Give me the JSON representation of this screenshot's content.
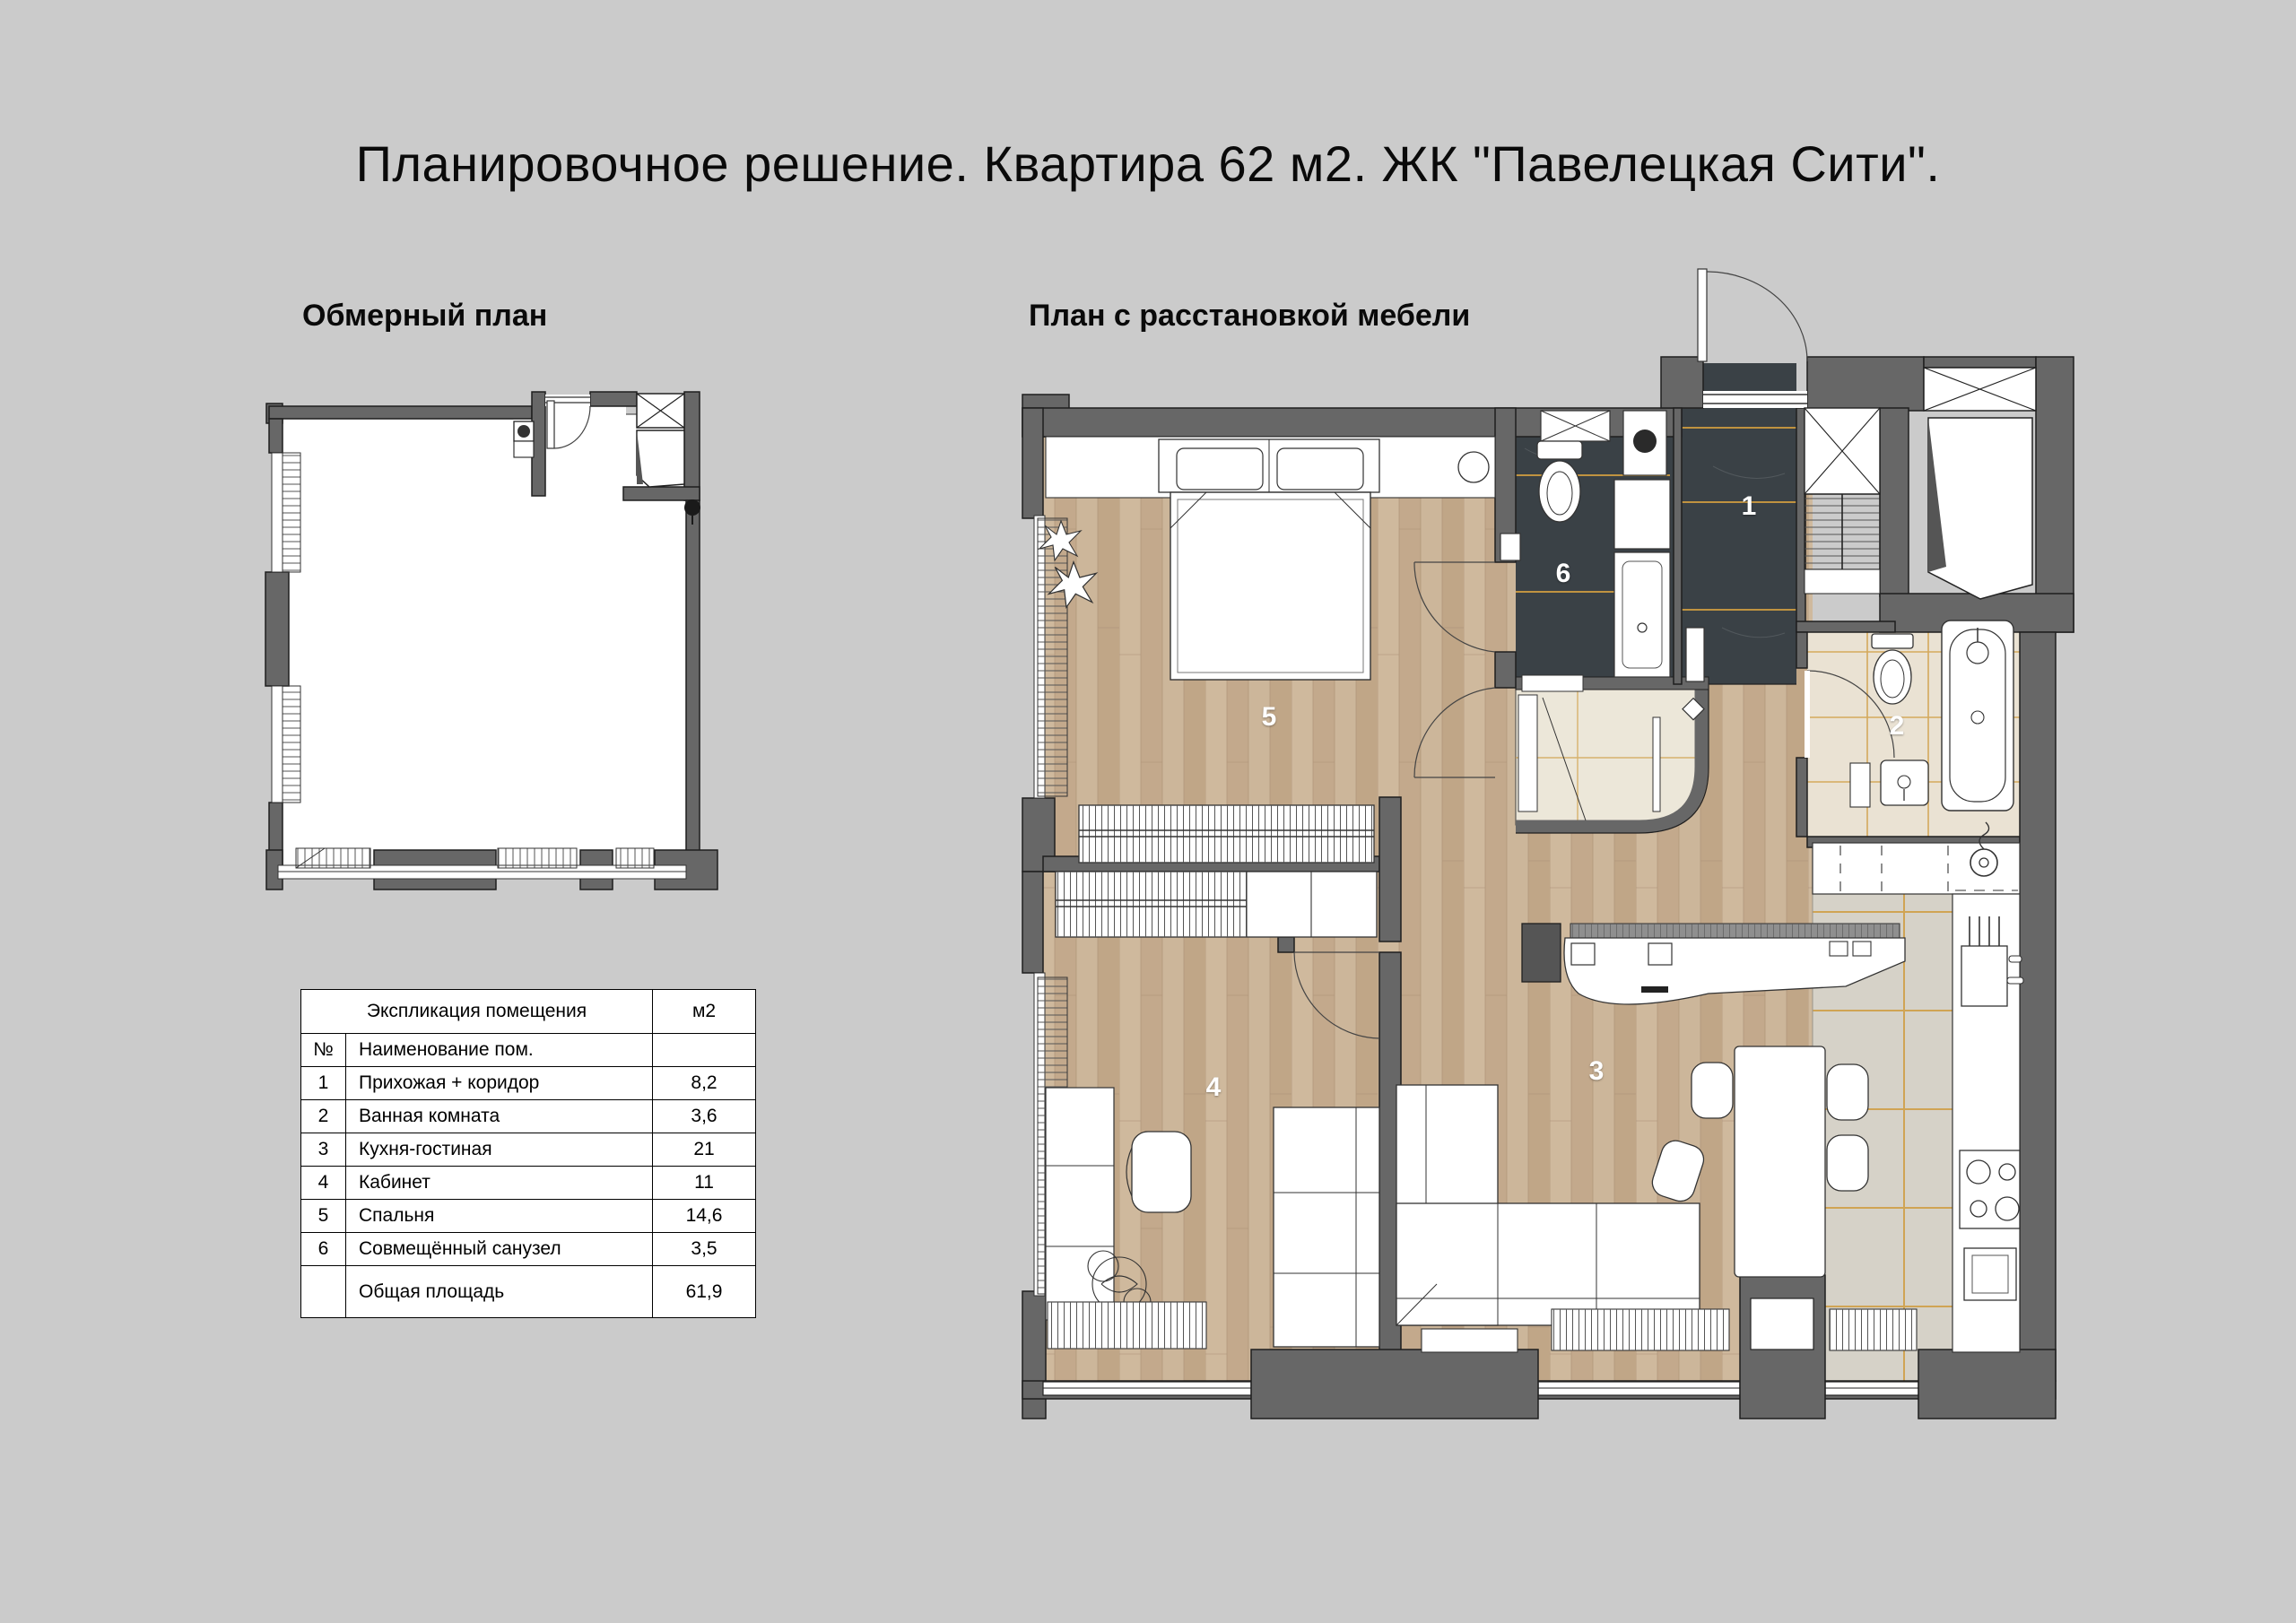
{
  "title": "Планировочное решение. Квартира 62 м2. ЖК \"Павелецкая Сити\".",
  "sections": {
    "left": "Обмерный план",
    "right": "План с расстановкой мебели"
  },
  "rooms": [
    {
      "label": "1"
    },
    {
      "label": "2"
    },
    {
      "label": "3"
    },
    {
      "label": "4"
    },
    {
      "label": "5"
    },
    {
      "label": "6"
    }
  ],
  "table": {
    "header": "Экспликация помещения",
    "unit": "м2",
    "col_num": "№",
    "col_name": "Наименование пом.",
    "rows": [
      {
        "num": "1",
        "name": "Прихожая + коридор",
        "area": "8,2"
      },
      {
        "num": "2",
        "name": "Ванная комната",
        "area": "3,6"
      },
      {
        "num": "3",
        "name": "Кухня-гостиная",
        "area": "21"
      },
      {
        "num": "4",
        "name": "Кабинет",
        "area": "11"
      },
      {
        "num": "5",
        "name": "Спальня",
        "area": "14,6"
      },
      {
        "num": "6",
        "name": "Совмещённый  санузел",
        "area": "3,5"
      }
    ],
    "total": {
      "label": "Общая площадь",
      "area": "61,9"
    }
  },
  "colors": {
    "background": "#cbcbcb",
    "wall": "#676767",
    "tile_dark": "#3a4146",
    "accent_orange": "#cf9c40",
    "wood": "#c8b195",
    "tile_beige": "#eae2d3",
    "tile_gray": "#d6d2c8"
  }
}
